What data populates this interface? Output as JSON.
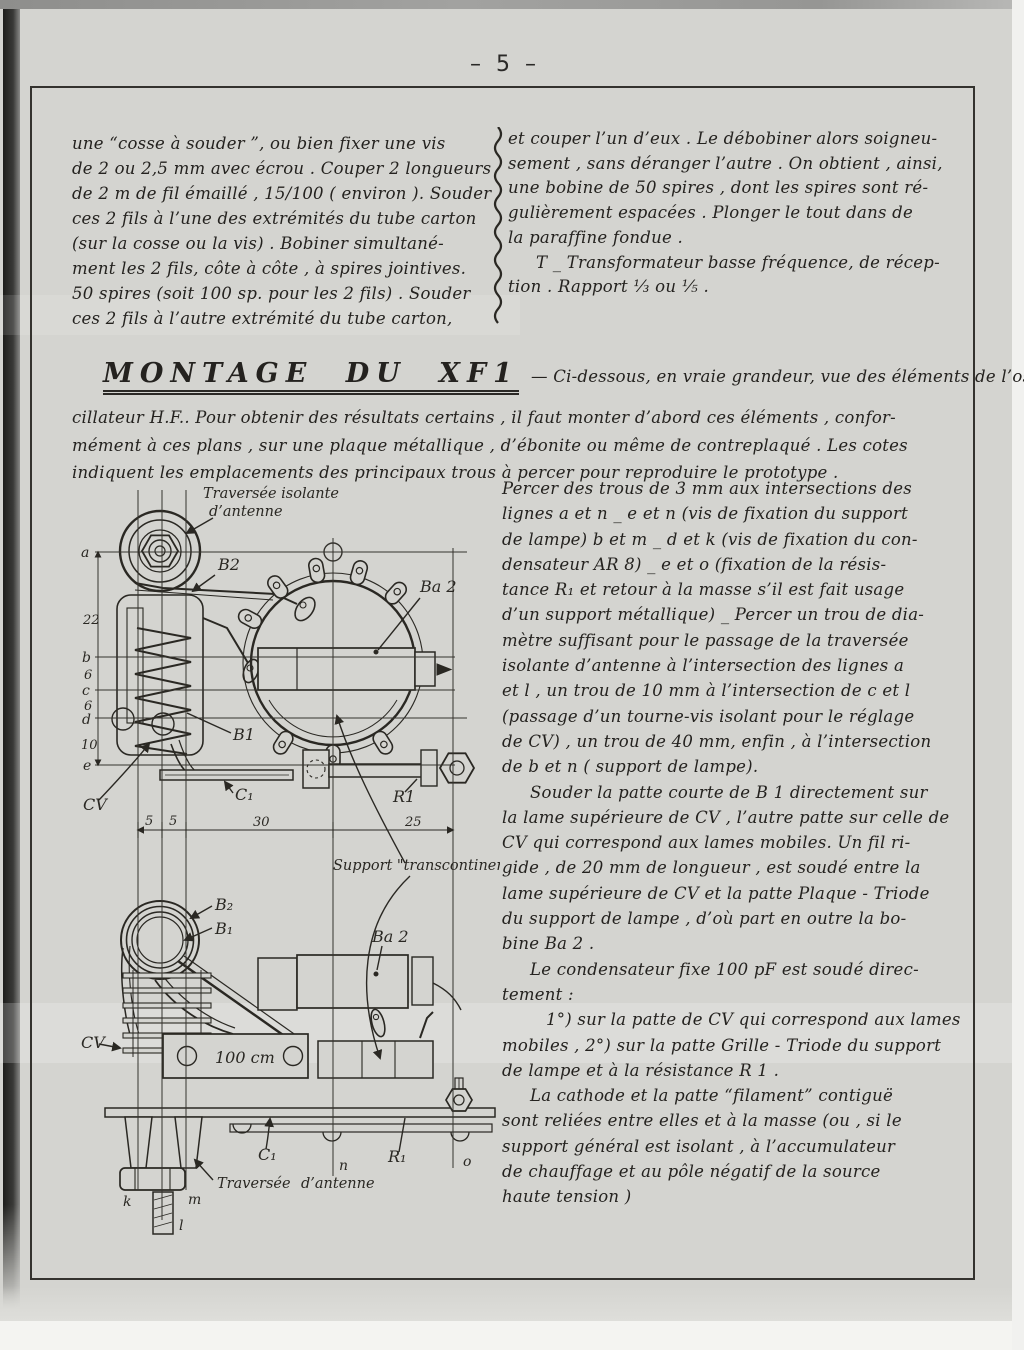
{
  "page": {
    "number": "– 5 –"
  },
  "intro_left": {
    "lines": [
      "une “cosse à souder ”, ou bien fixer une vis",
      "de 2 ou 2,5 mm avec écrou . Couper 2 longueurs",
      "de 2 m de fil émaillé , 15/100 ( environ ). Souder",
      "ces 2 fils à l’une des extrémités du tube carton",
      "(sur la cosse ou la vis) . Bobiner simultané-",
      "ment les 2 fils, côte à côte , à spires jointives.",
      "50 spires (soit 100 sp. pour les 2 fils) . Souder",
      "ces 2 fils à l’autre extrémité du tube carton,"
    ]
  },
  "intro_right": {
    "lines": [
      "et couper l’un d’eux . Le débobiner alors soigneu-",
      "sement , sans déranger l’autre . On obtient , ainsi,",
      "une bobine de 50 spires , dont les spires sont ré-",
      "gulièrement espacées . Plonger le tout dans de",
      "la paraffine fondue .",
      {
        "t": "T _ Transformateur basse fréquence, de récep-",
        "c": "ind"
      },
      "tion . Rapport  ⅓  ou  ⅕ ."
    ]
  },
  "montage": {
    "title": "MONTAGE DU XF1",
    "lead": "— Ci-dessous, en vraie grandeur, vue des éléments de l’os-",
    "lines": [
      "cillateur H.F.. Pour obtenir des résultats certains , il faut monter d’abord ces éléments , confor-",
      "mément à ces plans , sur une plaque métallique , d’ébonite ou même de contreplaqué . Les cotes",
      "indiquent les emplacements des principaux trous à percer pour reproduire le prototype ."
    ]
  },
  "body_right": {
    "lines": [
      "Percer des trous de 3 mm aux intersections des",
      "lignes a et n _ e et n (vis de fixation du support",
      "de lampe) b et m _ d et k (vis de fixation du con-",
      "densateur AR 8) _ e et o (fixation de la résis-",
      "tance R₁ et retour à la masse s’il est fait usage",
      "d’un support métallique) _ Percer un trou de dia-",
      "mètre suffisant pour le passage de la traversée",
      "isolante d’antenne à l’intersection des lignes a",
      "et l , un trou de 10 mm à l’intersection de c et l",
      "(passage d’un tourne-vis isolant pour le réglage",
      "de CV) , un trou de 40 mm, enfin , à l’intersection",
      "de b et n ( support de lampe).",
      {
        "t": "Souder la patte courte de B 1 directement sur",
        "c": "ind"
      },
      "la lame supérieure de CV , l’autre patte sur celle de",
      "CV qui correspond aux lames mobiles. Un fil ri-",
      "gide , de 20 mm de longueur , est soudé entre la",
      "lame supérieure de CV et la patte Plaque - Triode",
      "du support de lampe , d’où part en outre la bo-",
      "bine  Ba 2 .",
      {
        "t": "Le condensateur fixe 100 pF est soudé direc-",
        "c": "ind"
      },
      "tement  :",
      {
        "t": "1°) sur la patte de CV qui correspond aux lames",
        "c": "ind2"
      },
      "mobiles ,  2°) sur la patte Grille - Triode du support",
      "de lampe et à la résistance  R 1 .",
      {
        "t": "La cathode et la patte “filament” contiguë",
        "c": "ind"
      },
      "sont reliées entre elles et à la masse (ou , si le",
      "support général est isolant , à l’accumulateur",
      "de chauffage et au pôle négatif de la source",
      "haute tension )"
    ]
  },
  "diagram": {
    "caption1": "Traversée isolante",
    "caption2": "d’antenne",
    "support": "Support \"transcontinental\"",
    "top": {
      "b2": "B2",
      "ba2": "Ba 2",
      "b1": "B1",
      "cv": "CV",
      "c1": "C₁",
      "r1": "R1"
    },
    "grid": {
      "a": "a",
      "b": "b",
      "c": "c",
      "d": "d",
      "e": "e",
      "dab": "22",
      "dbc": "6",
      "dcd": "6",
      "dde": "10",
      "w1": "5",
      "w2": "5",
      "w3": "30",
      "w4": "25"
    },
    "side": {
      "b2": "B₂",
      "b1": "B₁",
      "ba2": "Ba 2",
      "cv": "CV",
      "plate": "100 cm",
      "c1": "C₁",
      "r1": "R₁",
      "n": "n",
      "o": "o",
      "k": "k",
      "m": "m",
      "l": "l",
      "trav1": "Traversée",
      "trav2": "d’antenne"
    }
  },
  "ink": "#2a2823",
  "paper_color": "#d4d4d0"
}
